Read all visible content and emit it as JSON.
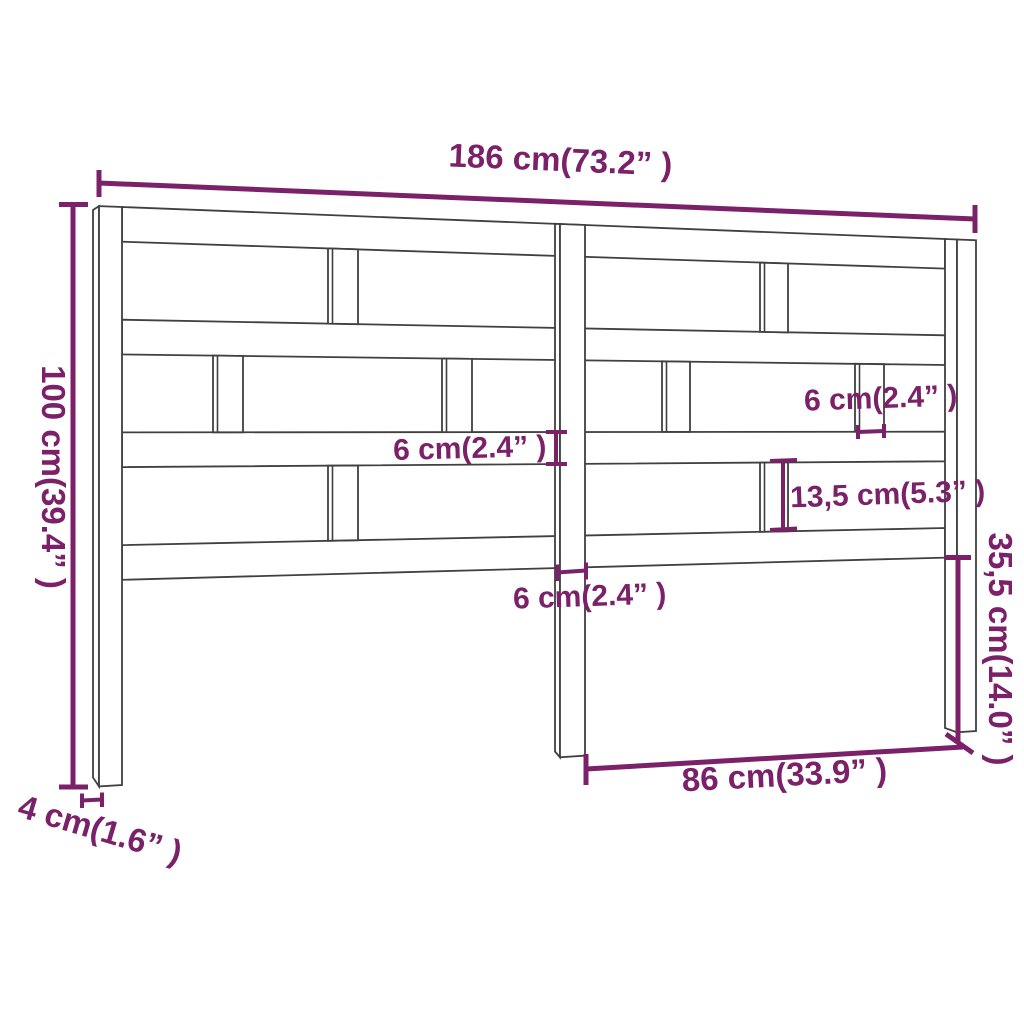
{
  "diagram": {
    "kind": "product-dimension-diagram",
    "subject": "bed headboard with horizontal slats, three posts and vertical spacers"
  },
  "colors": {
    "accent": "#7B2169",
    "line": "#404040",
    "background": "#FFFFFF"
  },
  "annotations": {
    "width_label": "186 cm(73.2” )",
    "height_label": "100 cm(39.4” )",
    "depth_label": "4 cm(1.6” )",
    "leg_height_label": "35,5 cm(14.0” )",
    "leg_span_label": "86 cm(33.9” )",
    "rail_thickness_label": "6 cm(2.4” )",
    "spacer_width_label": "6 cm(2.4” )",
    "post_width_label": "6 cm(2.4” )",
    "slat_gap_label": "13,5 cm(5.3” )"
  }
}
